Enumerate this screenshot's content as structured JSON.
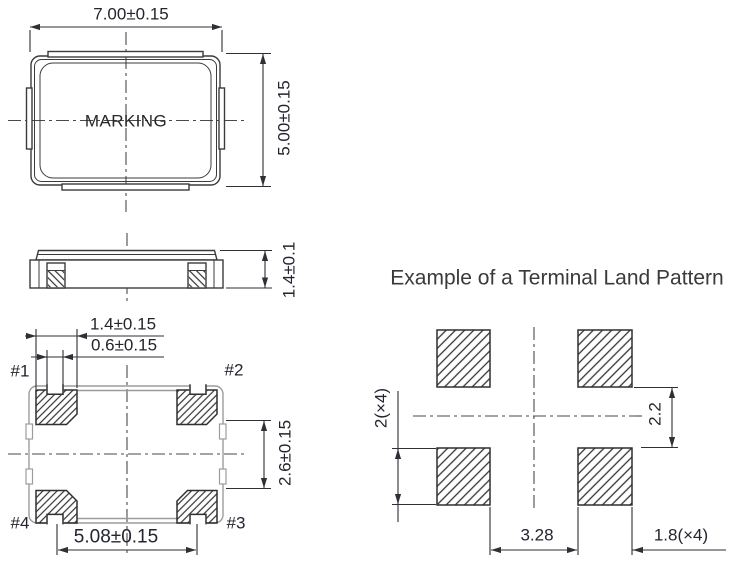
{
  "figure": {
    "type": "package-dimension-drawing",
    "colors": {
      "outline": "#3b3b3b",
      "pad_outline": "#2f2f2f",
      "body_outline_gray": "#9c9c9c",
      "dimension_text": "#23252e",
      "title_text": "#3a3a3a",
      "background": "#ffffff"
    },
    "top_view": {
      "marking": "MARKING",
      "width_dim": "7.00±0.15",
      "height_dim": "5.00±0.15"
    },
    "side_view": {
      "height_dim": "1.4±0.1"
    },
    "bottom_view": {
      "pad_width_dim": "1.4±0.15",
      "notch_width_dim": "0.6±0.15",
      "pad_gap_dim": "2.6±0.15",
      "pad_span_dim": "5.08±0.15",
      "pad_labels": [
        "#1",
        "#2",
        "#3",
        "#4"
      ]
    },
    "land_pattern": {
      "title": "Example of a Terminal Land Pattern",
      "pad_height_dim": "2(×4)",
      "vertical_gap_dim": "2.2",
      "horizontal_gap_dim": "3.28",
      "pad_width_dim": "1.8(×4)"
    }
  }
}
